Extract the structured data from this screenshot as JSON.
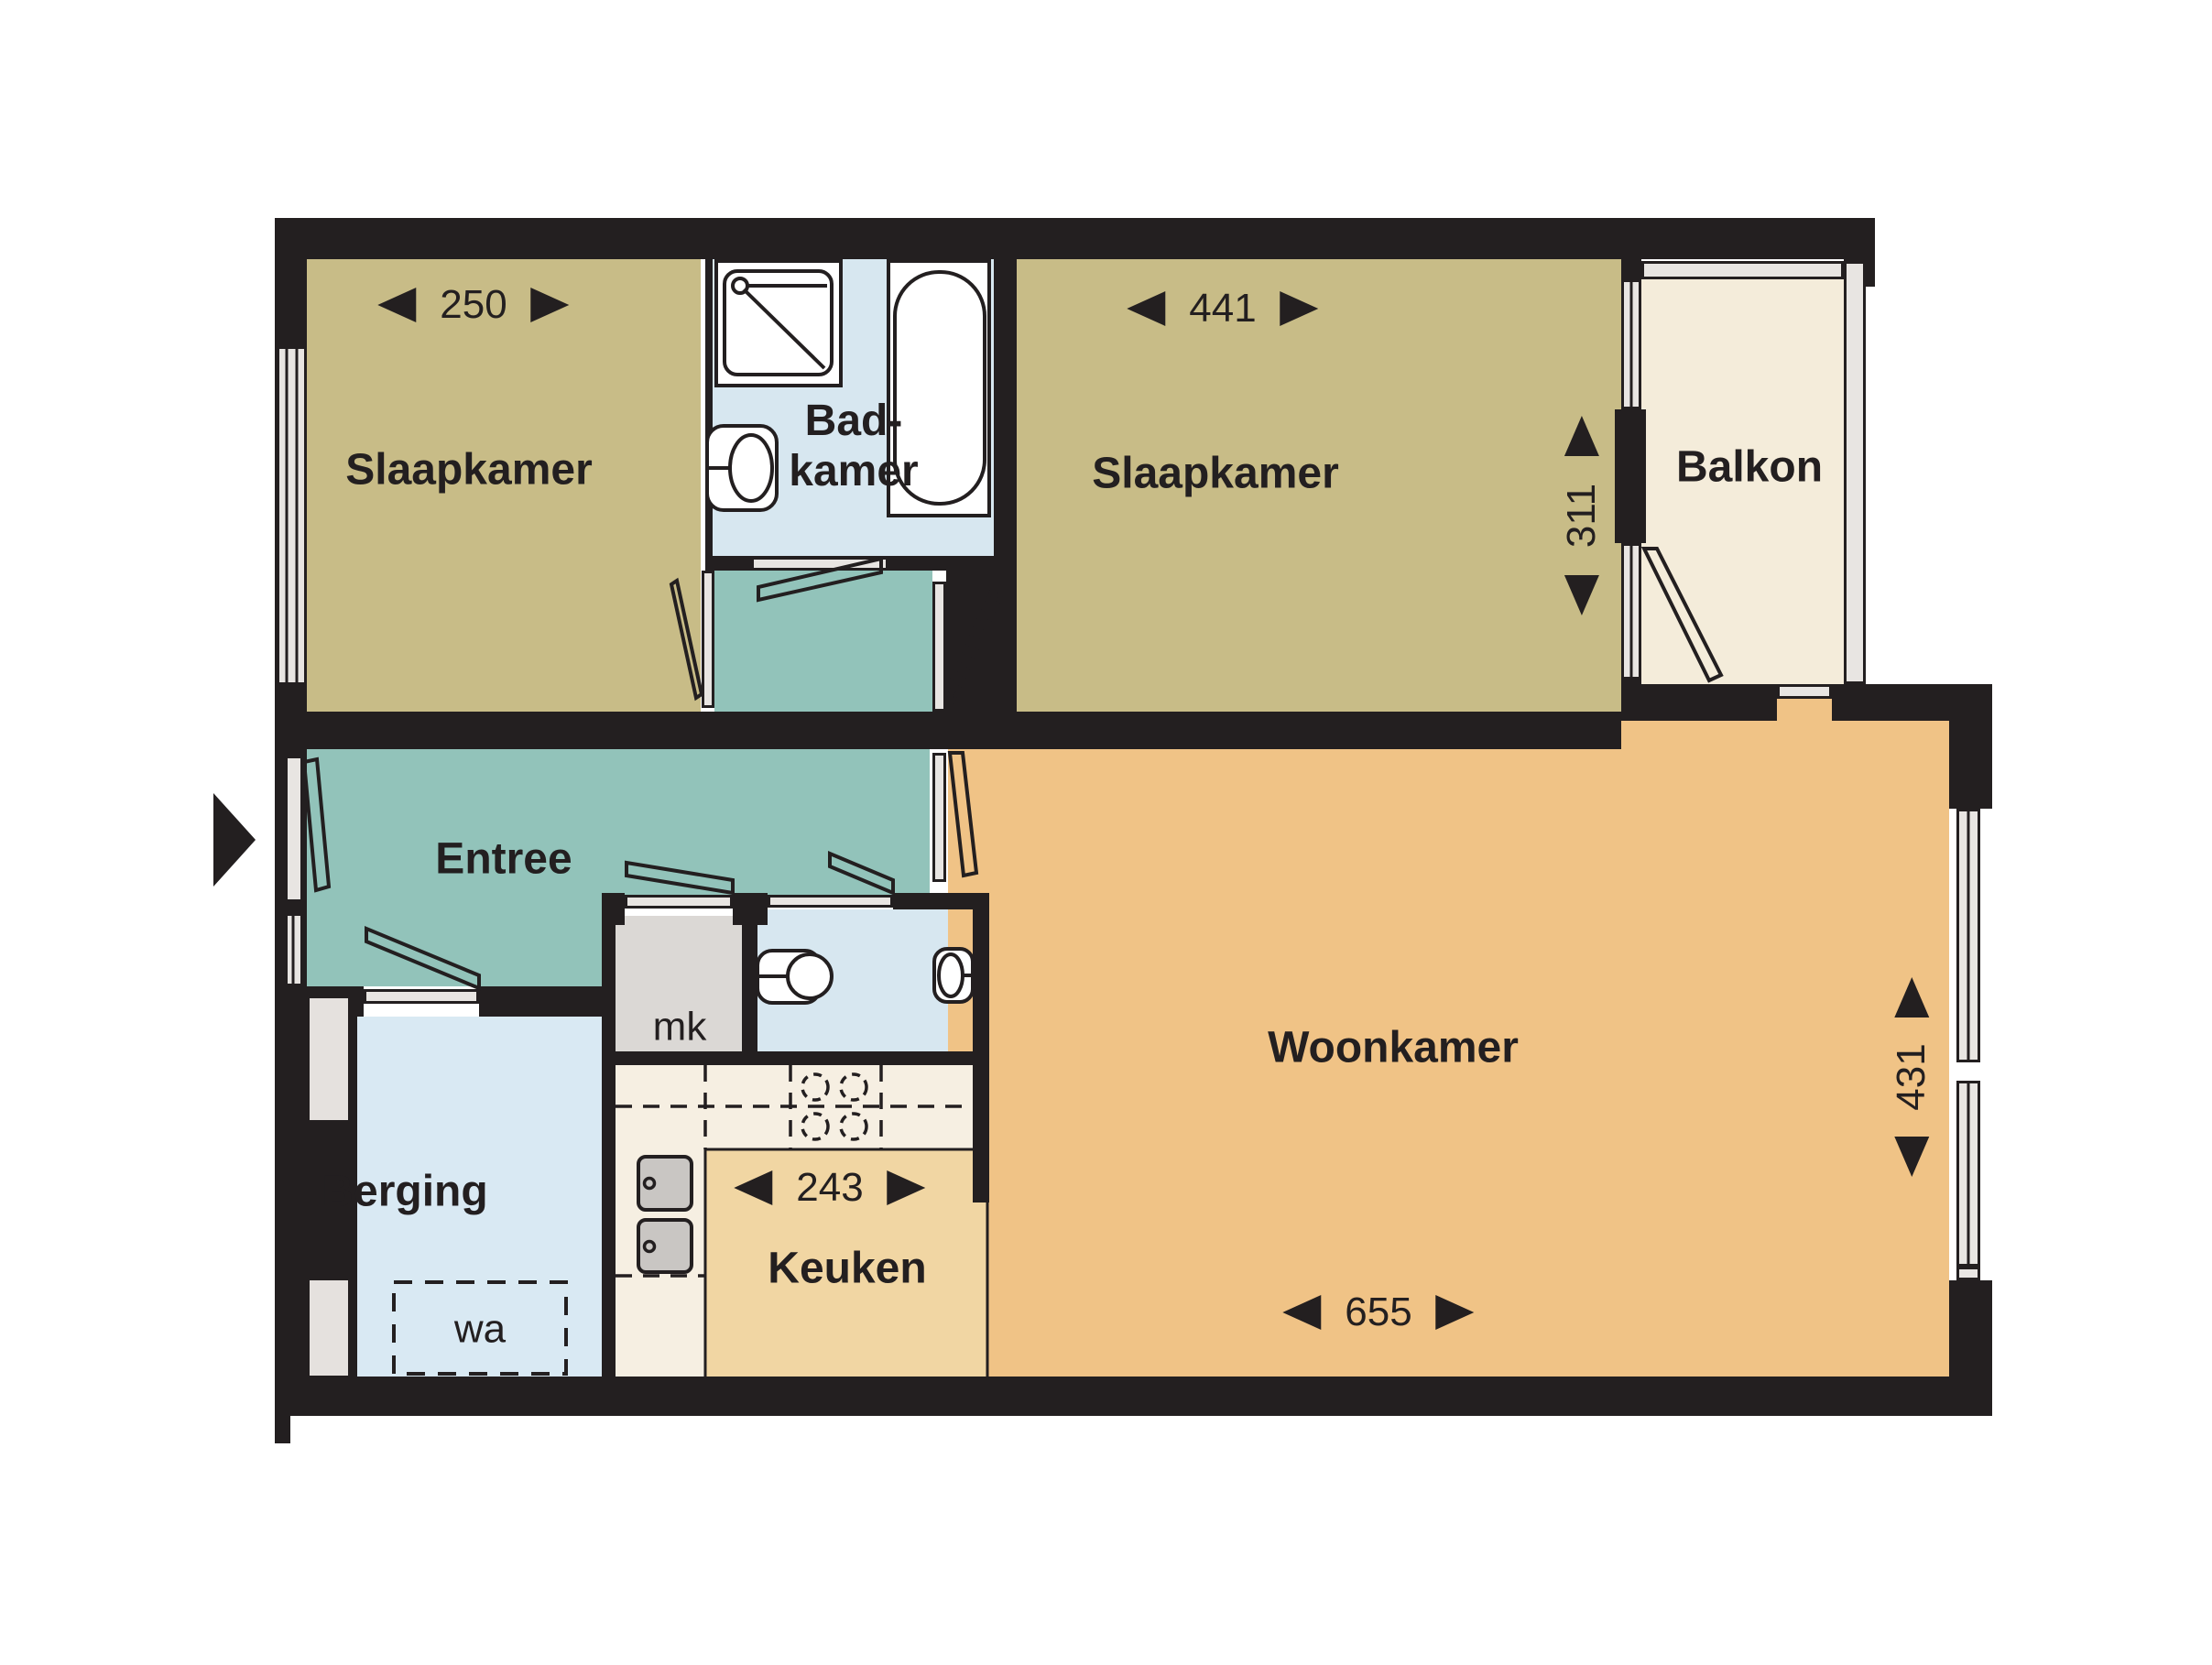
{
  "type": "floorplan",
  "language": "nl",
  "rooms": {
    "bedroom_left": {
      "label": "Slaapkamer",
      "dim_width_cm": "250"
    },
    "bathroom": {
      "label_line1": "Bad-",
      "label_line2": "kamer"
    },
    "bedroom_right": {
      "label": "Slaapkamer",
      "dim_width_cm": "441",
      "dim_depth_cm": "311"
    },
    "balcony": {
      "label": "Balkon"
    },
    "hallway": {
      "label": "Entree"
    },
    "storage": {
      "label": "Berging",
      "washer_label": "wa"
    },
    "meter_closet": {
      "label": "mk"
    },
    "kitchen": {
      "label": "Keuken",
      "dim_width_cm": "243"
    },
    "living_room": {
      "label": "Woonkamer",
      "dim_width_cm": "655",
      "dim_depth_cm": "431"
    }
  },
  "icons": {
    "entry_arrow": "triangle-right",
    "dim_arrow_left": "triangle-left",
    "dim_arrow_right": "triangle-right",
    "dim_arrow_up": "triangle-up",
    "dim_arrow_down": "triangle-down"
  },
  "colors": {
    "wall": "#231f20",
    "bedroom": "#c8bc87",
    "bathroom": "#d7e7f0",
    "hallway": "#92c3ba",
    "living": "#f0c386",
    "kitchen_floor": "#f1d6a3",
    "kitchen_counter": "#f6efe2",
    "storage": "#d9e9f3",
    "balcony": "#f4ecda",
    "window": "#e8e5e2",
    "appliance": "#c9c6c3"
  }
}
